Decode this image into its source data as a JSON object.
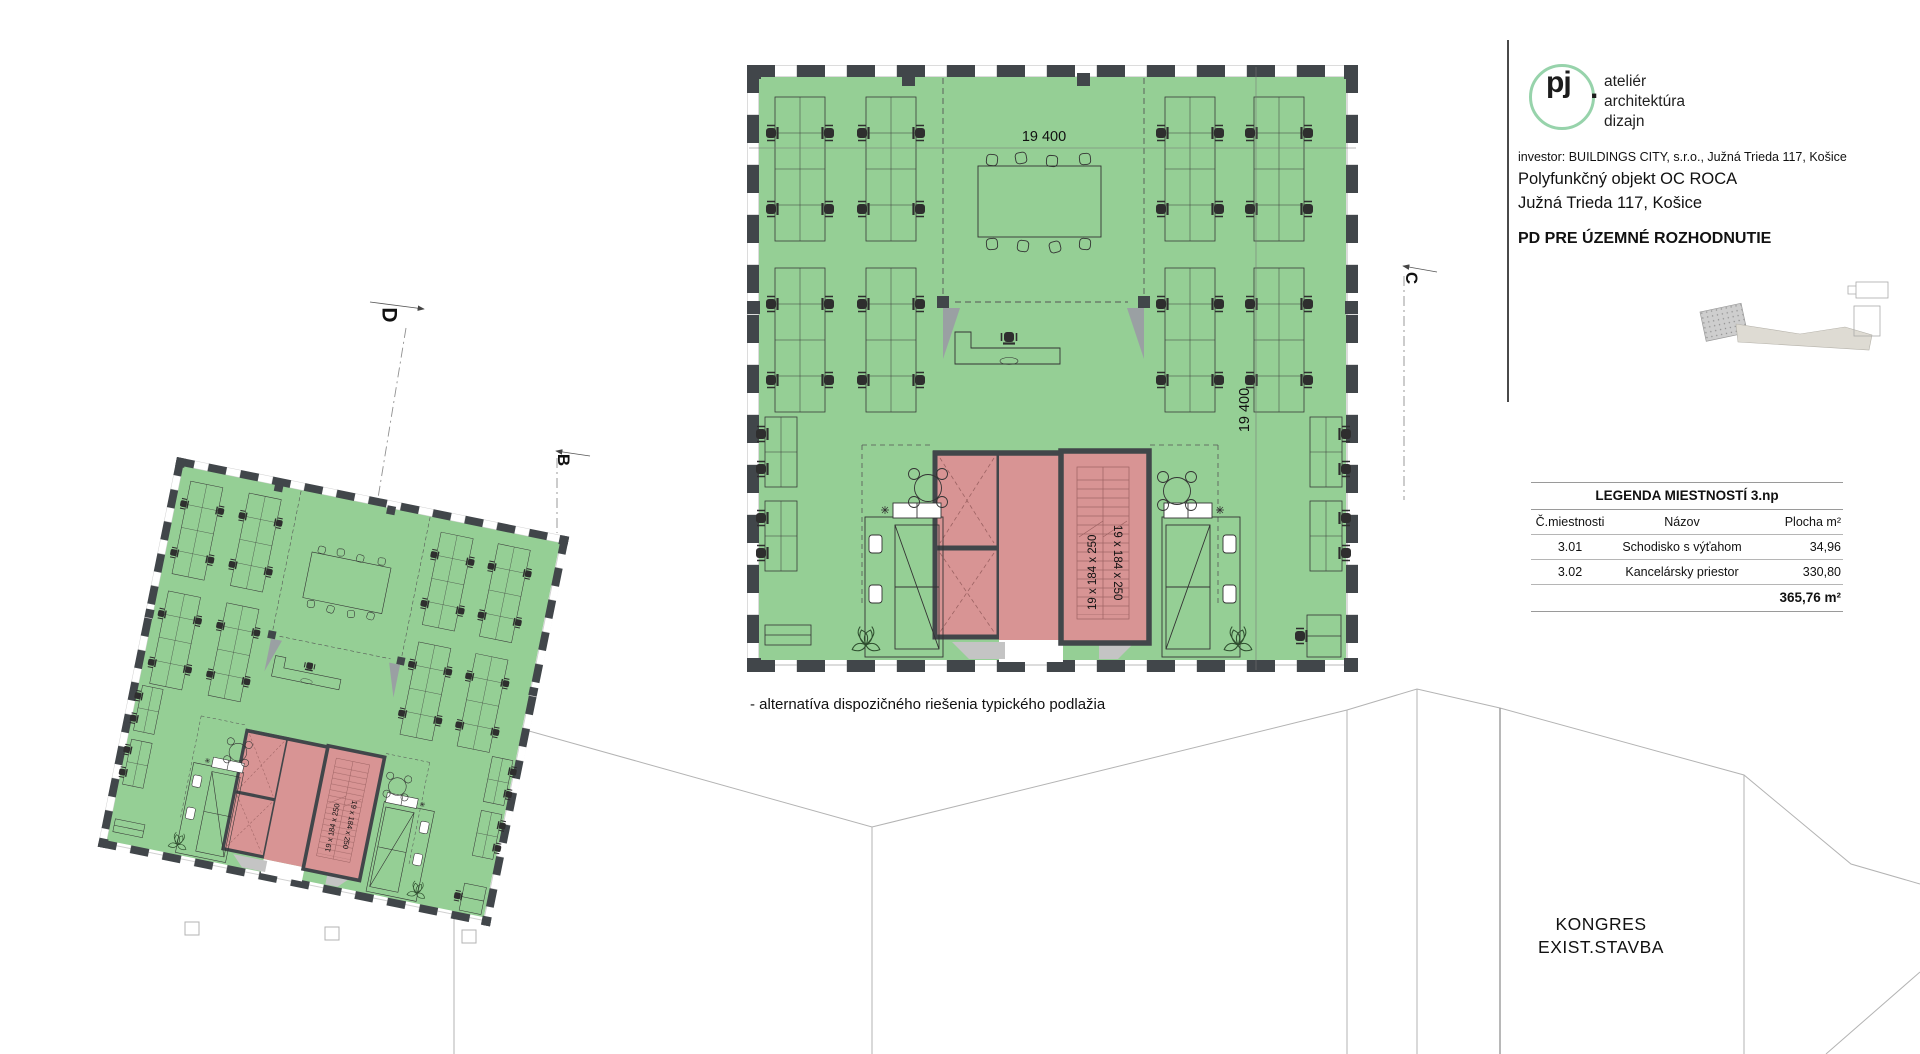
{
  "document": {
    "logo": {
      "monogram": "pj",
      "dot": ".",
      "line1": "ateliér",
      "line2": "architektúra",
      "line3": "dizajn"
    },
    "investor_line": "investor: BUILDINGS CITY, s.r.o., Južná Trieda 117, Košice",
    "project_name": "Polyfunkčný objekt OC ROCA",
    "project_address": "Južná Trieda 117,  Košice",
    "stage": "PD PRE ÚZEMNÉ ROZHODNUTIE"
  },
  "legend": {
    "title": "LEGENDA MIESTNOSTÍ 3.np",
    "col_nr": "Č.miestnosti",
    "col_name": "Názov",
    "col_area": "Plocha m²",
    "rows": [
      {
        "nr": "3.01",
        "name": "Schodisko s výťahom",
        "area": "34,96"
      },
      {
        "nr": "3.02",
        "name": "Kancelársky priestor",
        "area": "330,80"
      }
    ],
    "total_area": "365,76 m²"
  },
  "plan": {
    "dim_width": "19 400",
    "dim_height": "19 400",
    "stair_flight_label": "19 x 184 x 250",
    "caption": "- alternatíva dispozičného riešenia typického podlažia"
  },
  "section_markers": {
    "d": "D",
    "b": "B",
    "c": "C"
  },
  "site": {
    "line1": "KONGRES",
    "line2": "EXIST.STAVBA"
  },
  "colors": {
    "office_green": "#95cf95",
    "core_pink": "#d89494",
    "wall_dark": "#41464a",
    "logo_green": "#97d3ab",
    "existing_outline_gray": "#b3b3b3",
    "keyplan_gray": "#c9c9c9"
  }
}
